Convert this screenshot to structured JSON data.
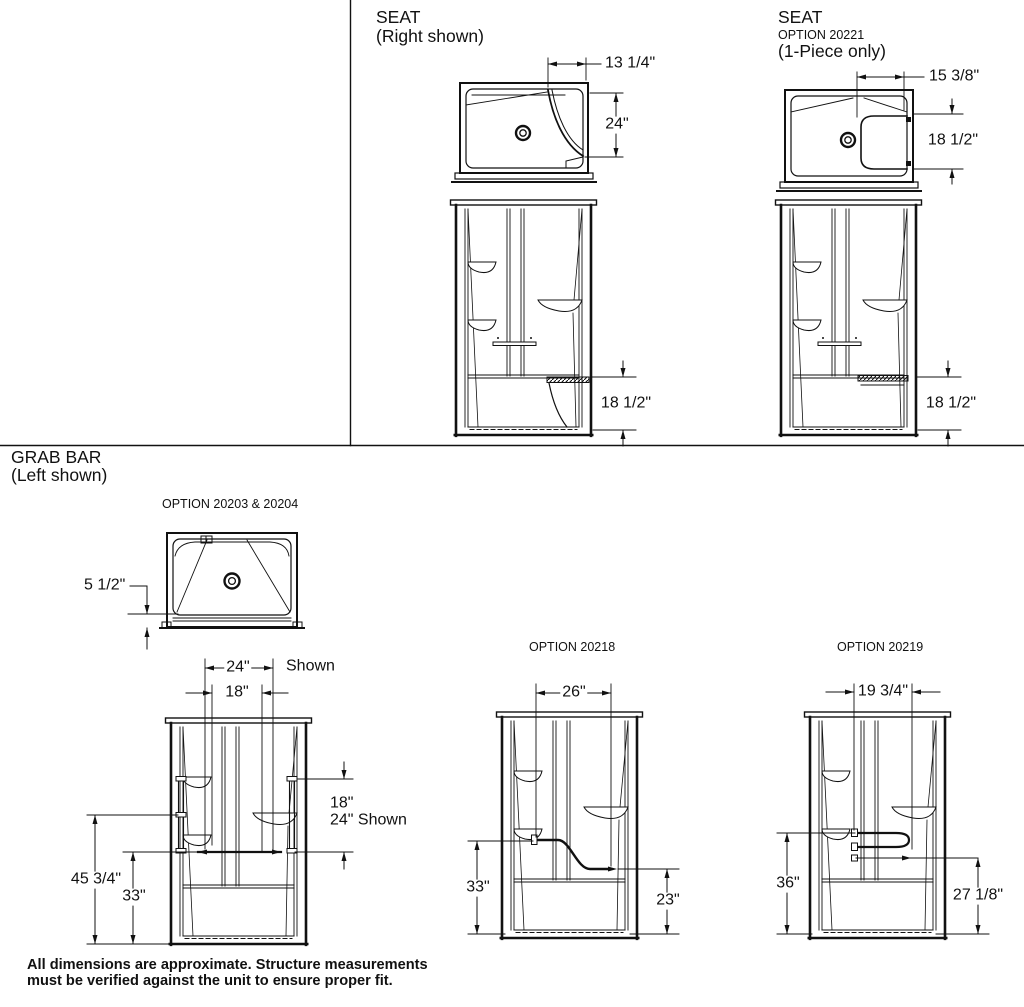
{
  "sections": {
    "seat": {
      "title": "SEAT",
      "subtitle": "(Right shown)"
    },
    "seat_option": {
      "title": "SEAT",
      "option": "OPTION 20221",
      "subtitle": "(1-Piece only)"
    },
    "grab_bar": {
      "title": "GRAB BAR",
      "subtitle": "(Left shown)"
    }
  },
  "options": {
    "grab_left": "OPTION 20203 & 20204",
    "opt_20218": "OPTION 20218",
    "opt_20219": "OPTION 20219"
  },
  "dims": {
    "seat_right": {
      "top_width": "13 1/4\"",
      "top_depth": "24\"",
      "height": "18 1/2\""
    },
    "seat_20221": {
      "top_width": "15 3/8\"",
      "seat_depth": "18 1/2\"",
      "height": "18 1/2\""
    },
    "grab_left": {
      "curb": "5 1/2\"",
      "width_shown": "24\"",
      "width_shown_note": "Shown",
      "width_alt": "18\"",
      "right_line1": "18\"",
      "right_line2": "24\" Shown",
      "total_height": "45 3/4\"",
      "bar_height": "33\""
    },
    "opt_20218": {
      "width": "26\"",
      "left_height": "33\"",
      "right_height": "23\""
    },
    "opt_20219": {
      "width": "19 3/4\"",
      "left_height": "36\"",
      "right_height": "27 1/8\""
    }
  },
  "footnote": {
    "line1": "All dimensions are approximate. Structure measurements",
    "line2": "must be verified against the unit to ensure proper fit."
  }
}
